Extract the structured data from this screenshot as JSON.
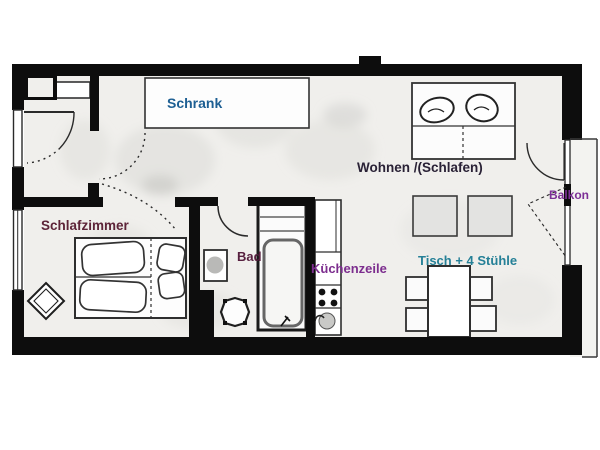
{
  "plan": {
    "type": "apartment-floor-plan",
    "rooms": [
      {
        "id": "schrank",
        "label": "Schrank",
        "color": "#1d5f93"
      },
      {
        "id": "wohnen",
        "label": "Wohnen /(Schlafen)",
        "color": "#2a2236"
      },
      {
        "id": "balkon",
        "label": "Balkon",
        "color": "#7c2f96"
      },
      {
        "id": "schlafzimmer",
        "label": "Schlafzimmer",
        "color": "#5d2438"
      },
      {
        "id": "bad",
        "label": "Bad",
        "color": "#57203f"
      },
      {
        "id": "kuechenzeile",
        "label": "Küchenzeile",
        "color": "#7c2d8e"
      },
      {
        "id": "esstisch",
        "label": "Tisch + 4 Stühle",
        "color": "#258097"
      }
    ],
    "colors": {
      "wall": "#0d0d0d",
      "floor": "#f0efec",
      "line": "#2e2e2e"
    }
  }
}
